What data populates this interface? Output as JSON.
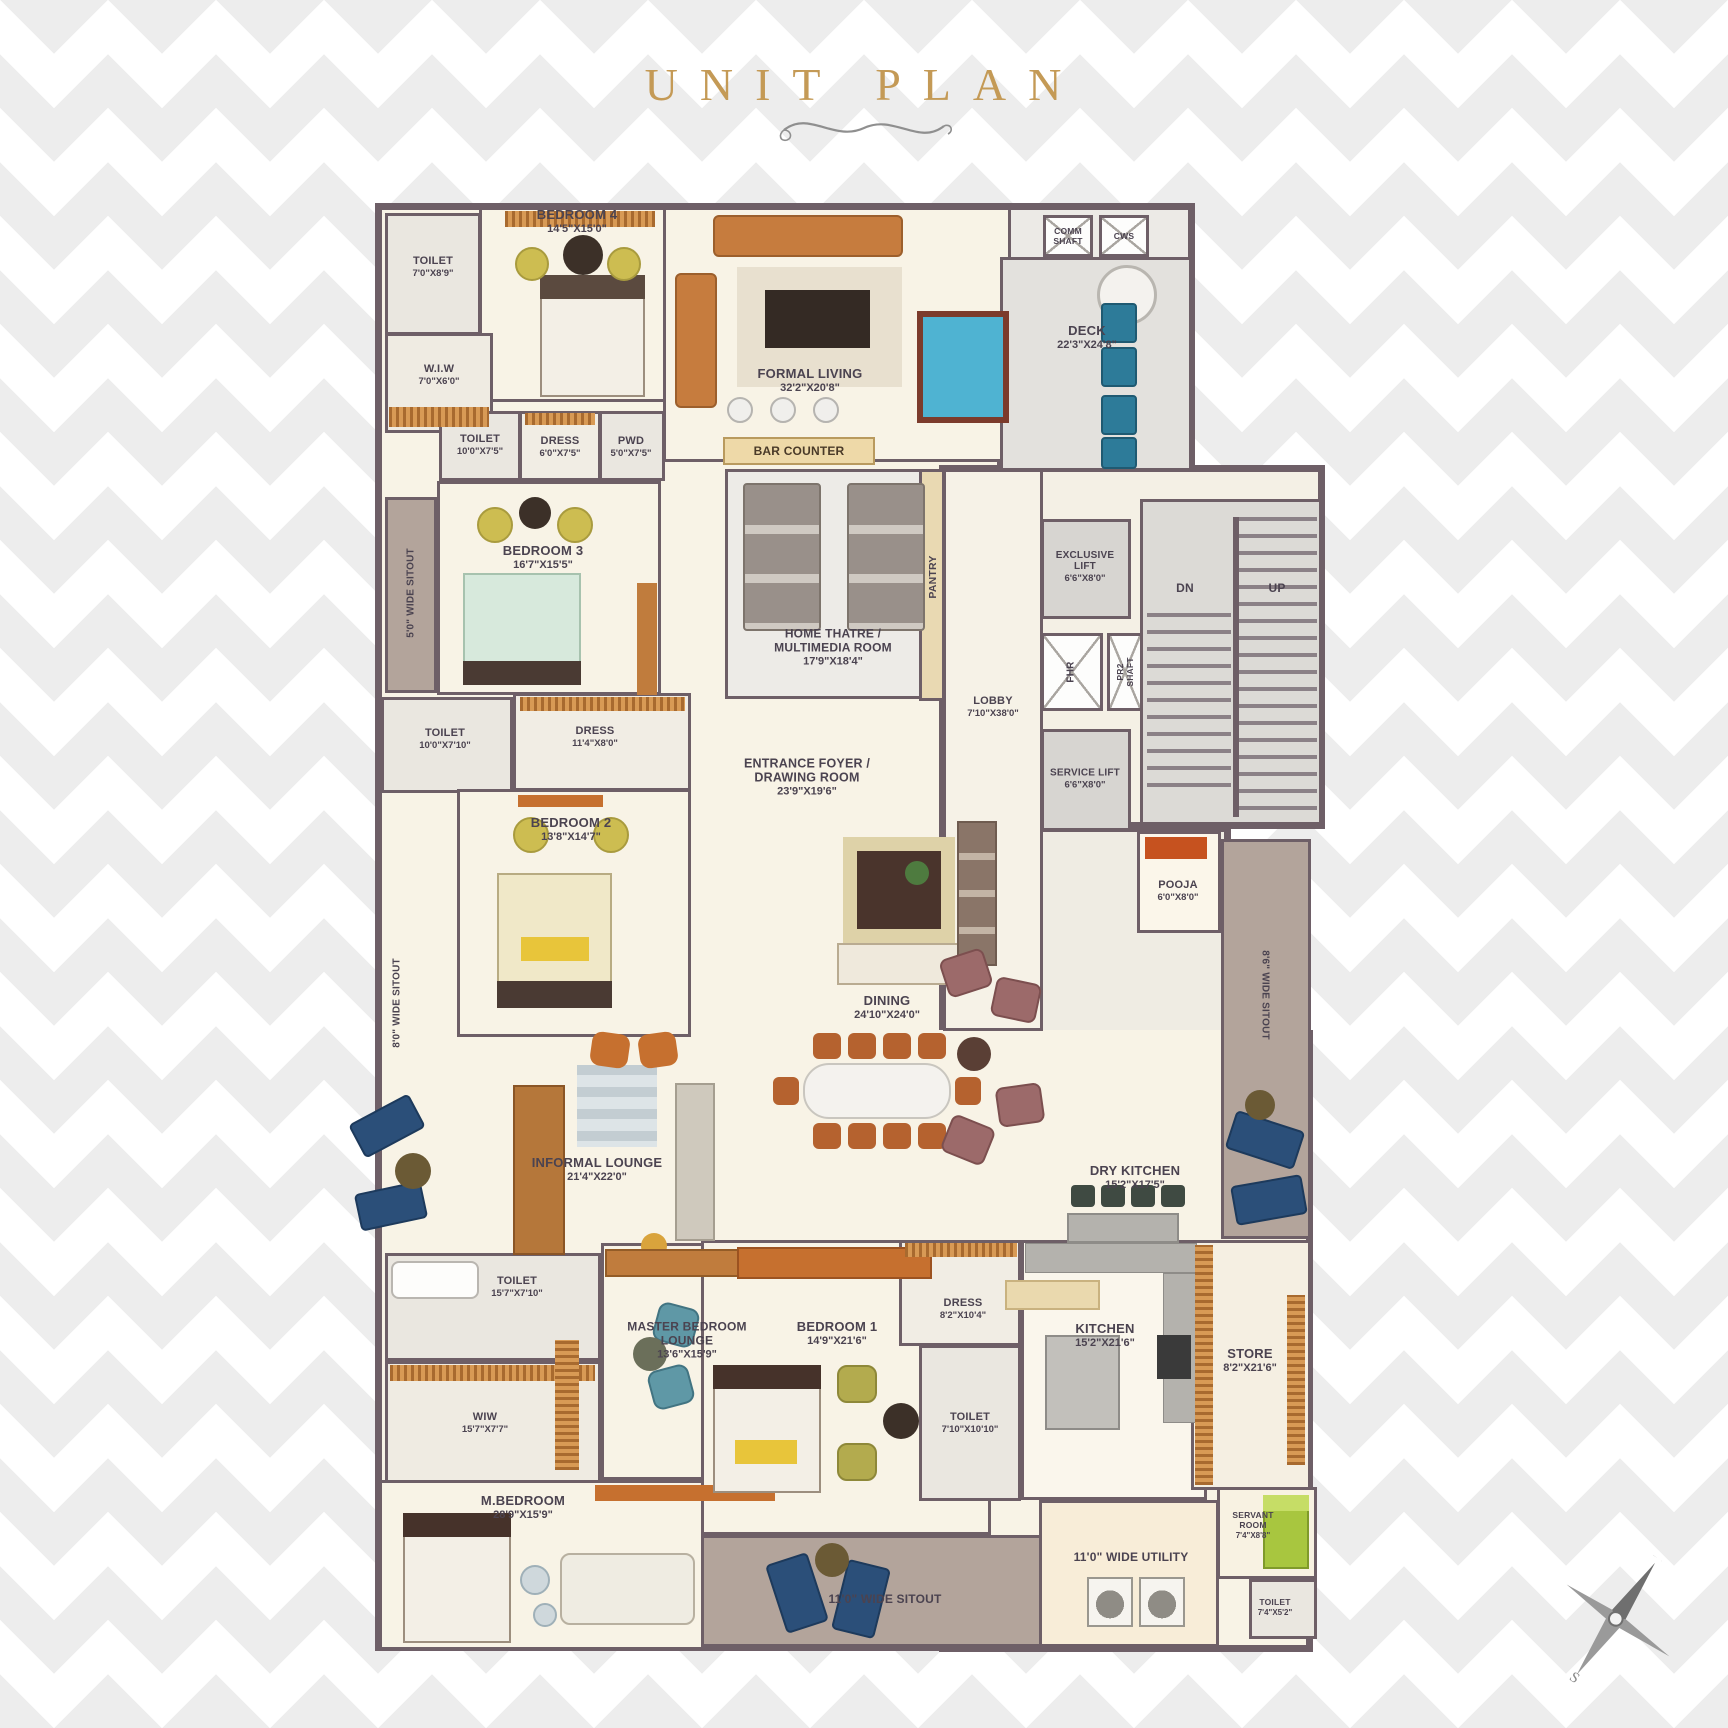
{
  "title": "UNIT PLAN",
  "colors": {
    "accent_gold": "#c49a56",
    "wall": "#6e5f67",
    "floor_cream": "#f8f3e6",
    "floor_gray": "#e3e1dd",
    "sitout_taupe": "#b3a49b",
    "pool_felt": "#4fb3d2",
    "deck_chair_blue": "#2d7b99",
    "wood_orange": "#c6702f"
  },
  "rooms": {
    "toilet_bed4": {
      "name": "TOILET",
      "dims": "7'0\"X8'9\""
    },
    "bedroom4": {
      "name": "BEDROOM 4",
      "dims": "14'5\"X15'0\""
    },
    "wiw_bed4": {
      "name": "W.I.W",
      "dims": "7'0\"X6'0\""
    },
    "toilet_bed3": {
      "name": "TOILET",
      "dims": "10'0\"X7'5\""
    },
    "dress_bed3": {
      "name": "DRESS",
      "dims": "6'0\"X7'5\""
    },
    "pwd": {
      "name": "PWD",
      "dims": "5'0\"X7'5\""
    },
    "formal_living": {
      "name": "FORMAL LIVING",
      "dims": "32'2\"X20'8\""
    },
    "bar_counter": {
      "name": "BAR COUNTER"
    },
    "comm_shaft": {
      "name": "COMM SHAFT"
    },
    "cws": {
      "name": "CWS"
    },
    "deck": {
      "name": "DECK",
      "dims": "22'3\"X24'8\""
    },
    "sitout_5": {
      "name": "5'0\" WIDE SITOUT"
    },
    "bedroom3": {
      "name": "BEDROOM 3",
      "dims": "16'7\"X15'5\""
    },
    "toilet_bed2": {
      "name": "TOILET",
      "dims": "10'0\"X7'10\""
    },
    "dress_bed2": {
      "name": "DRESS",
      "dims": "11'4\"X8'0\""
    },
    "bedroom2": {
      "name": "BEDROOM 2",
      "dims": "13'8\"X14'7\""
    },
    "home_theatre": {
      "name": "HOME THATRE / MULTIMEDIA ROOM",
      "dims": "17'9\"X18'4\""
    },
    "pantry": {
      "name": "PANTRY"
    },
    "lobby": {
      "name": "LOBBY",
      "dims": "7'10\"X38'0\""
    },
    "exclusive_lift": {
      "name": "EXCLUSIVE LIFT",
      "dims": "6'6\"X8'0\""
    },
    "fhr": {
      "name": "FHR"
    },
    "pr2_shaft": {
      "name": "PR2 SHAFT"
    },
    "service_lift": {
      "name": "SERVICE LIFT",
      "dims": "6'6\"X8'0\""
    },
    "entrance_foyer": {
      "name": "ENTRANCE FOYER / DRAWING ROOM",
      "dims": "23'9\"X19'6\""
    },
    "pooja": {
      "name": "POOJA",
      "dims": "6'0\"X8'0\""
    },
    "sitout_8": {
      "name": "8'0\" WIDE SITOUT"
    },
    "sitout_86": {
      "name": "8'6\" WIDE SITOUT"
    },
    "dining": {
      "name": "DINING",
      "dims": "24'10\"X24'0\""
    },
    "informal_lounge": {
      "name": "INFORMAL LOUNGE",
      "dims": "21'4\"X22'0\""
    },
    "dry_kitchen": {
      "name": "DRY KITCHEN",
      "dims": "15'2\"X17'5\""
    },
    "toilet_m": {
      "name": "TOILET",
      "dims": "15'7\"X7'10\""
    },
    "wiw_m": {
      "name": "WIW",
      "dims": "15'7\"X7'7\""
    },
    "mbr_lounge": {
      "name": "MASTER BEDROOM LOUNGE",
      "dims": "13'6\"X15'9\""
    },
    "m_bedroom": {
      "name": "M.BEDROOM",
      "dims": "28'9\"X15'9\""
    },
    "bedroom1": {
      "name": "BEDROOM 1",
      "dims": "14'9\"X21'6\""
    },
    "dress_bed1": {
      "name": "DRESS",
      "dims": "8'2\"X10'4\""
    },
    "toilet_bed1": {
      "name": "TOILET",
      "dims": "7'10\"X10'10\""
    },
    "kitchen": {
      "name": "KITCHEN",
      "dims": "15'2\"X21'6\""
    },
    "store": {
      "name": "STORE",
      "dims": "8'2\"X21'6\""
    },
    "sitout_11": {
      "name": "11'0\" WIDE SITOUT"
    },
    "utility": {
      "name": "11'0\" WIDE UTILITY"
    },
    "servant_room": {
      "name": "SERVANT ROOM",
      "dims": "7'4\"X8'8\""
    },
    "toilet_servant": {
      "name": "TOILET",
      "dims": "7'4\"X5'2\""
    }
  },
  "stairs": {
    "dn": "DN",
    "up": "UP"
  },
  "compass": {
    "n": "N",
    "e": "E",
    "s": "S",
    "w": "W"
  }
}
